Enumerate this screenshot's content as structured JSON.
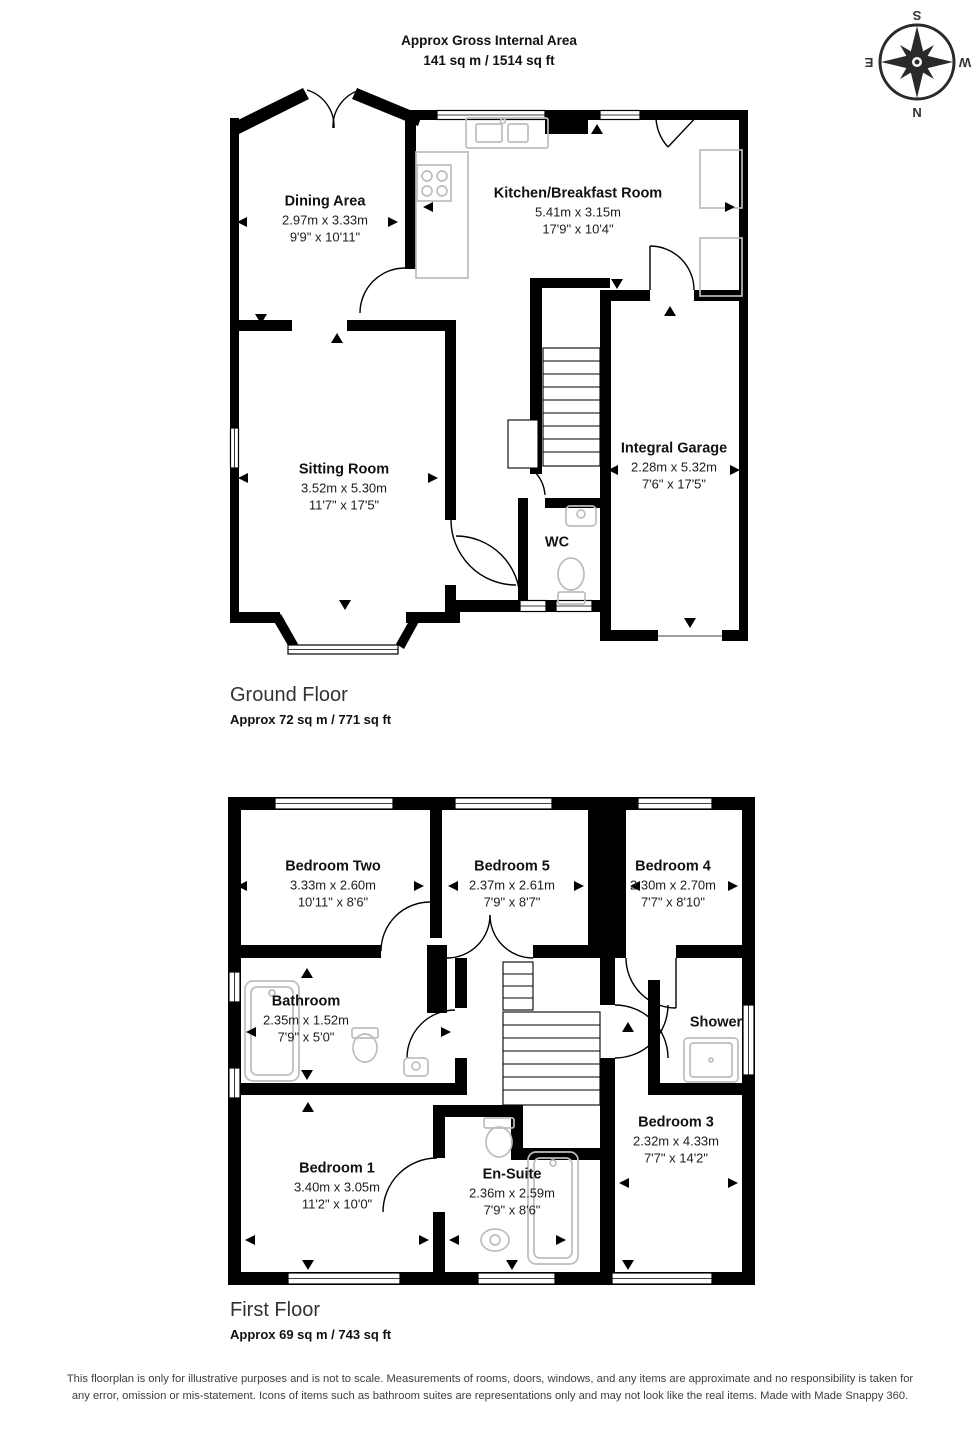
{
  "header": {
    "line1": "Approx Gross Internal Area",
    "line2": "141 sq m / 1514 sq ft"
  },
  "compass": {
    "top": "S",
    "bottom": "N",
    "left": "E",
    "right": "W"
  },
  "ground_floor": {
    "title": "Ground Floor",
    "area": "Approx 72 sq m / 771 sq ft",
    "rooms": [
      {
        "name": "Dining Area",
        "dim_m": "2.97m x 3.33m",
        "dim_ft": "9'9\" x 10'11\""
      },
      {
        "name": "Kitchen/Breakfast Room",
        "dim_m": "5.41m x 3.15m",
        "dim_ft": "17'9\" x 10'4\""
      },
      {
        "name": "Sitting Room",
        "dim_m": "3.52m x 5.30m",
        "dim_ft": "11'7\" x 17'5\""
      },
      {
        "name": "Integral Garage",
        "dim_m": "2.28m x 5.32m",
        "dim_ft": "7'6\" x 17'5\""
      },
      {
        "name": "WC"
      }
    ]
  },
  "first_floor": {
    "title": "First Floor",
    "area": "Approx 69 sq m / 743 sq ft",
    "rooms": [
      {
        "name": "Bedroom Two",
        "dim_m": "3.33m x 2.60m",
        "dim_ft": "10'11\" x 8'6\""
      },
      {
        "name": "Bedroom 5",
        "dim_m": "2.37m x 2.61m",
        "dim_ft": "7'9\" x 8'7\""
      },
      {
        "name": "Bedroom 4",
        "dim_m": "2.30m x 2.70m",
        "dim_ft": "7'7\" x 8'10\""
      },
      {
        "name": "Bathroom",
        "dim_m": "2.35m x 1.52m",
        "dim_ft": "7'9\" x 5'0\""
      },
      {
        "name": "Shower"
      },
      {
        "name": "Bedroom 3",
        "dim_m": "2.32m x 4.33m",
        "dim_ft": "7'7\" x 14'2\""
      },
      {
        "name": "Bedroom 1",
        "dim_m": "3.40m x 3.05m",
        "dim_ft": "11'2\" x 10'0\""
      },
      {
        "name": "En-Suite",
        "dim_m": "2.36m x 2.59m",
        "dim_ft": "7'9\" x 8'6\""
      }
    ]
  },
  "disclaimer": "This floorplan is only for illustrative purposes and is not to scale. Measurements of rooms, doors, windows, and any items are approximate and no responsibility is taken for any error, omission or mis-statement. Icons of items such as bathroom suites are representations only and may not look like the real items. Made with Made Snappy 360."
}
